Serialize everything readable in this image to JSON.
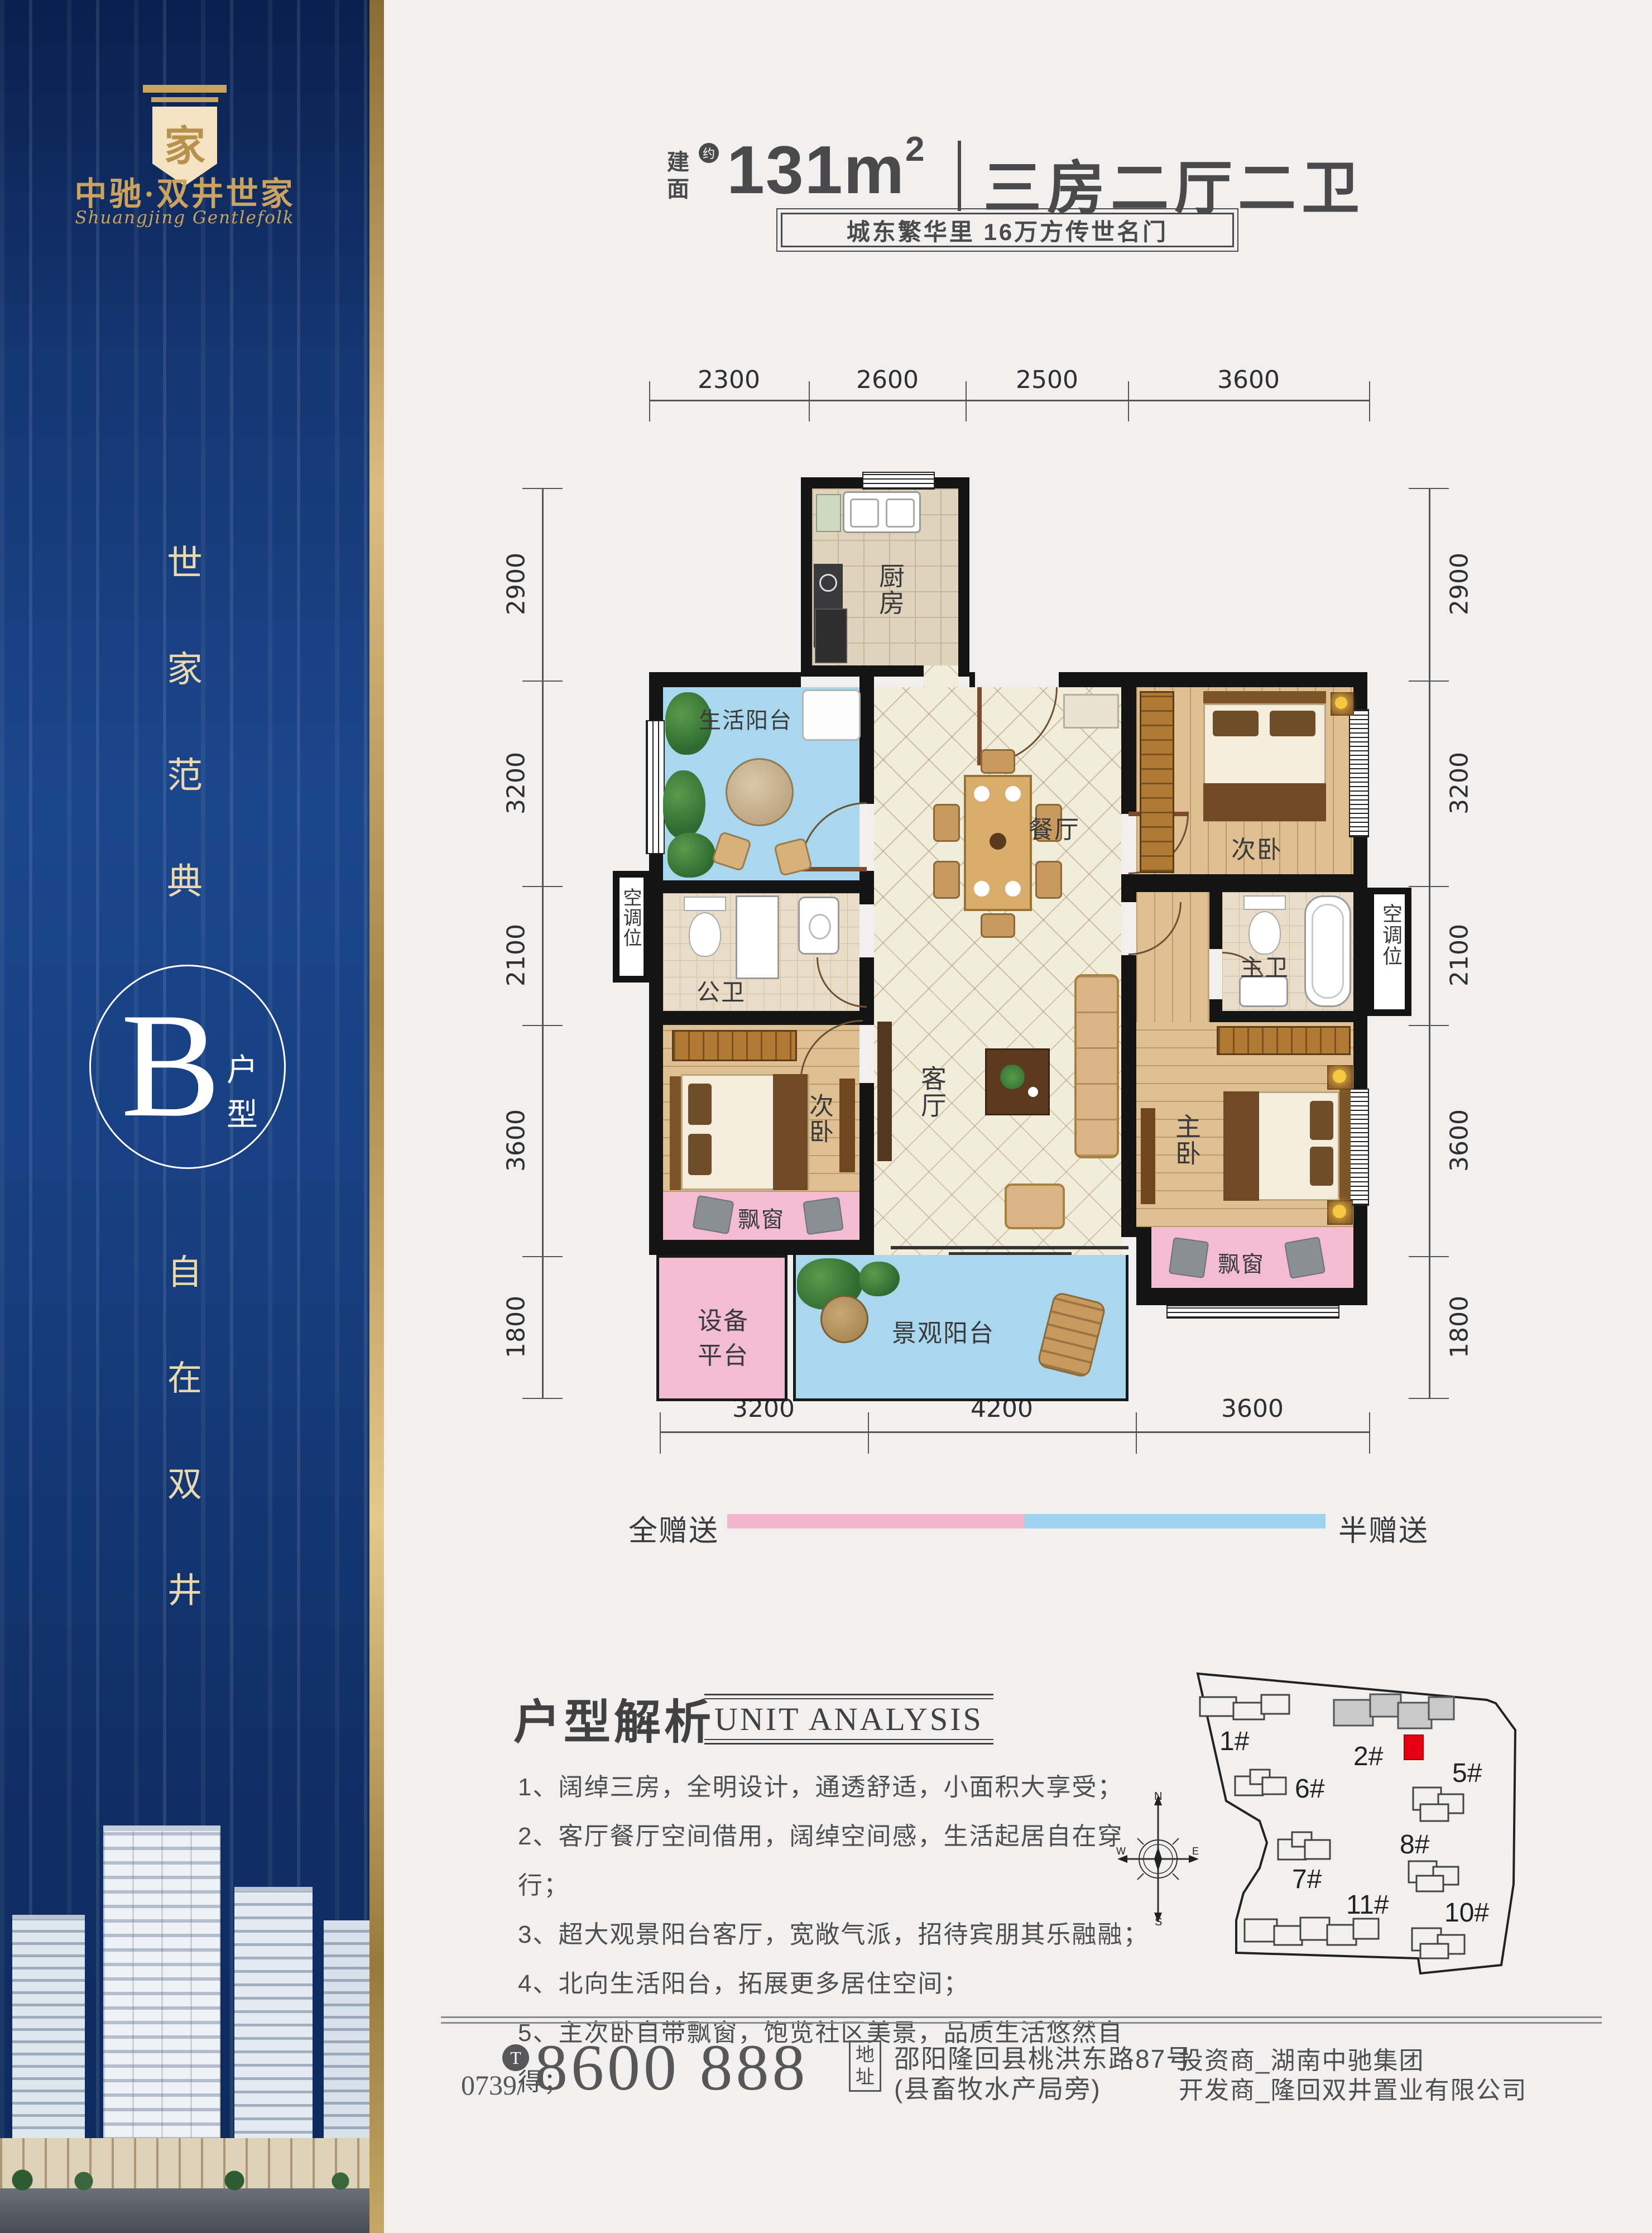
{
  "sidebar": {
    "logo_char": "家",
    "brand": "中驰·双井世家",
    "brand_en": "Shuangjing Gentlefolk",
    "vertical_top": [
      "世",
      "家",
      "范",
      "典"
    ],
    "unit_letter": "B",
    "unit_type": [
      "户",
      "型"
    ],
    "vertical_bottom": [
      "自",
      "在",
      "双",
      "井"
    ],
    "colors": {
      "navy": "#12306b",
      "gold": "#c9a35f",
      "cream": "#ead9ae"
    }
  },
  "header": {
    "area_prefix": [
      "建",
      "面"
    ],
    "approx_badge": "约",
    "area_value": "131m",
    "area_sup": "2",
    "divider": "|",
    "layout_title": "三房二厅二卫",
    "subtitle": "城东繁华里  16万方传世名门"
  },
  "floorplan": {
    "dims_top": [
      "2300",
      "2600",
      "2500",
      "3600"
    ],
    "dims_bottom": [
      "3200",
      "4200",
      "3600"
    ],
    "dims_left": [
      "2900",
      "3200",
      "2100",
      "3600",
      "1800"
    ],
    "dims_right": [
      "2900",
      "3200",
      "2100",
      "3600",
      "1800"
    ],
    "rooms": {
      "kitchen": "厨房",
      "life_balcony": "生活阳台",
      "dining": "餐厅",
      "bedroom_top": "次卧",
      "bedroom_bottom": "次卧",
      "ac_left": "空调位",
      "ac_right": "空调位",
      "bath_public": "公卫",
      "bath_master": "主卫",
      "living": "客厅",
      "master": "主卧",
      "bay_left": "飘窗",
      "bay_master": "飘窗",
      "equipment_l1": "设备",
      "equipment_l2": "平台",
      "view_balcony": "景观阳台"
    },
    "legend": {
      "full": "全赠送",
      "half": "半赠送",
      "full_color": "#f0b6cb",
      "half_color": "#9fd2ef"
    }
  },
  "analysis": {
    "title_cn": "户型解析",
    "title_en": "UNIT ANALYSIS",
    "items": [
      "1、阔绰三房，全明设计，通透舒适，小面积大享受；",
      "2、客厅餐厅空间借用，阔绰空间感，生活起居自在穿行；",
      "3、超大观景阳台客厅，宽敞气派，招待宾朋其乐融融；",
      "4、北向生活阳台，拓展更多居住空间；",
      "5、主次卧自带飘窗，饱览社区美景，品质生活悠然自得；"
    ]
  },
  "compass": {
    "n": "N",
    "s": "S",
    "w": "W",
    "e": "E"
  },
  "sitemap": {
    "buildings": [
      {
        "label": "1#"
      },
      {
        "label": "2#"
      },
      {
        "label": "5#"
      },
      {
        "label": "6#"
      },
      {
        "label": "7#"
      },
      {
        "label": "8#"
      },
      {
        "label": "11#"
      },
      {
        "label": "10#"
      }
    ],
    "highlight_color": "#e60012"
  },
  "footer": {
    "phone_icon": "T",
    "phone_prefix": "0739/",
    "phone_number": "8600 888",
    "addr_label": [
      "地",
      "址"
    ],
    "addr_line1": "邵阳隆回县桃洪东路87号",
    "addr_line2": "(县畜牧水产局旁)",
    "investor": "投资商_湖南中驰集团",
    "developer": "开发商_隆回双井置业有限公司"
  }
}
